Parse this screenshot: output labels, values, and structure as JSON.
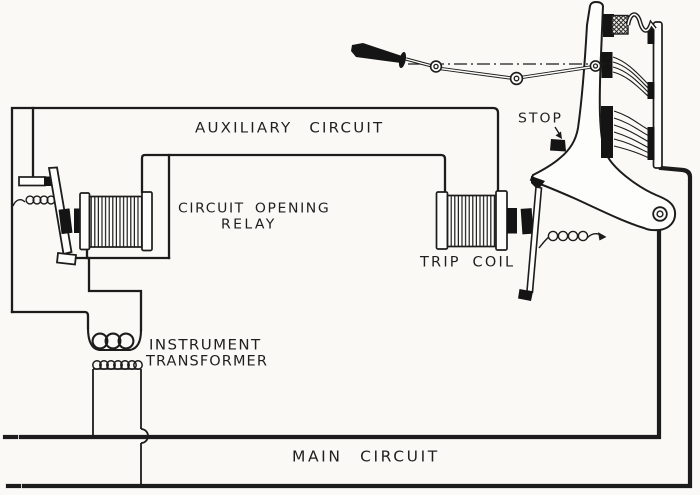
{
  "figure": {
    "background_color": "#faf9f6",
    "ink_color": "#1c1c1c",
    "labels": {
      "auxiliary_circuit": "AUXILIARY CIRCUIT",
      "circuit_opening_relay_line1": "CIRCUIT OPENING",
      "circuit_opening_relay_line2": "RELAY",
      "trip_coil": "TRIP COIL",
      "stop": "STOP",
      "instrument_transformer_line1": "INSTRUMENT",
      "instrument_transformer_line2": "TRANSFORMER",
      "main_circuit": "MAIN CIRCUIT"
    }
  }
}
